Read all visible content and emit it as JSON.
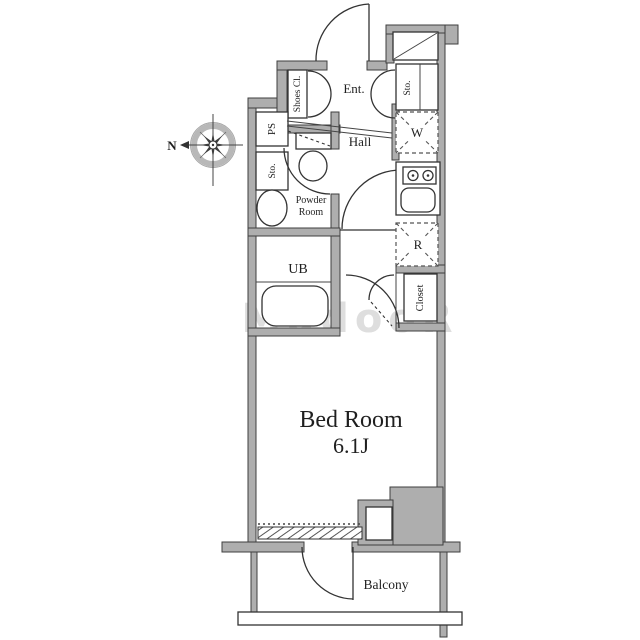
{
  "floorplan": {
    "compass": {
      "north_label": "N"
    },
    "labels": {
      "entrance": "Ent.",
      "hall": "Hall",
      "shoes_closet": "Shoes Cl.",
      "entrance_storage": "Sto.",
      "pipe_space": "PS",
      "storage": "Sto.",
      "powder_room_line1": "Powder",
      "powder_room_line2": "Room",
      "unit_bath": "UB",
      "washer": "W",
      "refrigerator": "R",
      "closet": "Closet",
      "bedroom_name": "Bed Room",
      "bedroom_size": "6.1J",
      "balcony": "Balcony"
    },
    "watermark": "MadooR",
    "colors": {
      "wall_fill": "#aeaeae",
      "line": "#333333",
      "background": "#ffffff",
      "watermark": "#c4c4c4"
    }
  }
}
